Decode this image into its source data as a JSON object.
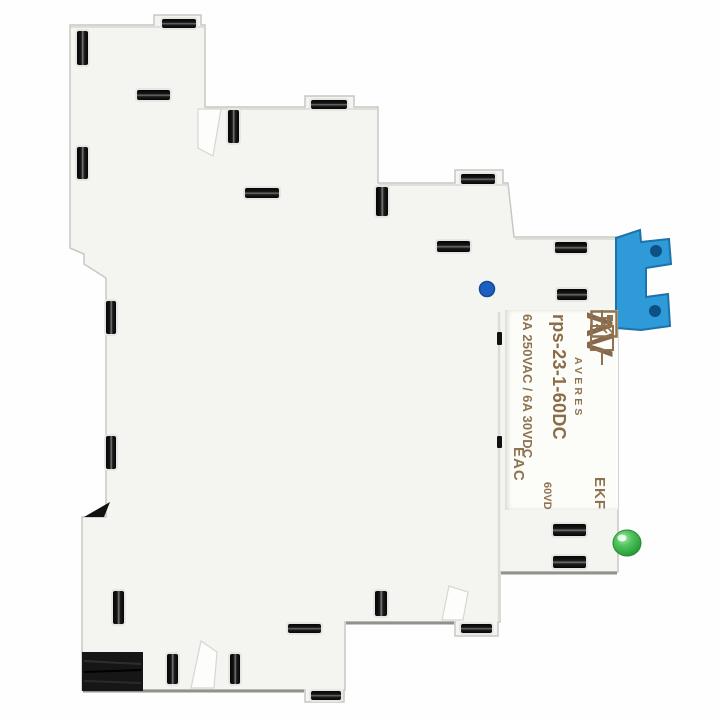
{
  "photo": {
    "label": {
      "brand_logo": "ΛV",
      "brand": "AVERES",
      "model": "rps-23-1-60DC",
      "ratings": "6A 250VAC / 6A 30VDC",
      "coil_voltage": "60VDC",
      "manufacturer": "EKF",
      "cert_mark": "EAC"
    },
    "colors": {
      "body_white": "#f4f4f1",
      "slot_black": "#141414",
      "label_text_brown": "#8e7350",
      "din_clip_blue": "#2e9ad8",
      "clip_hole_blue": "#0d5085",
      "led_green": "#3cb94c",
      "indicator_blue": "#1d5fc0",
      "din_rail_black": "#161616",
      "background": "#fefefe"
    }
  }
}
